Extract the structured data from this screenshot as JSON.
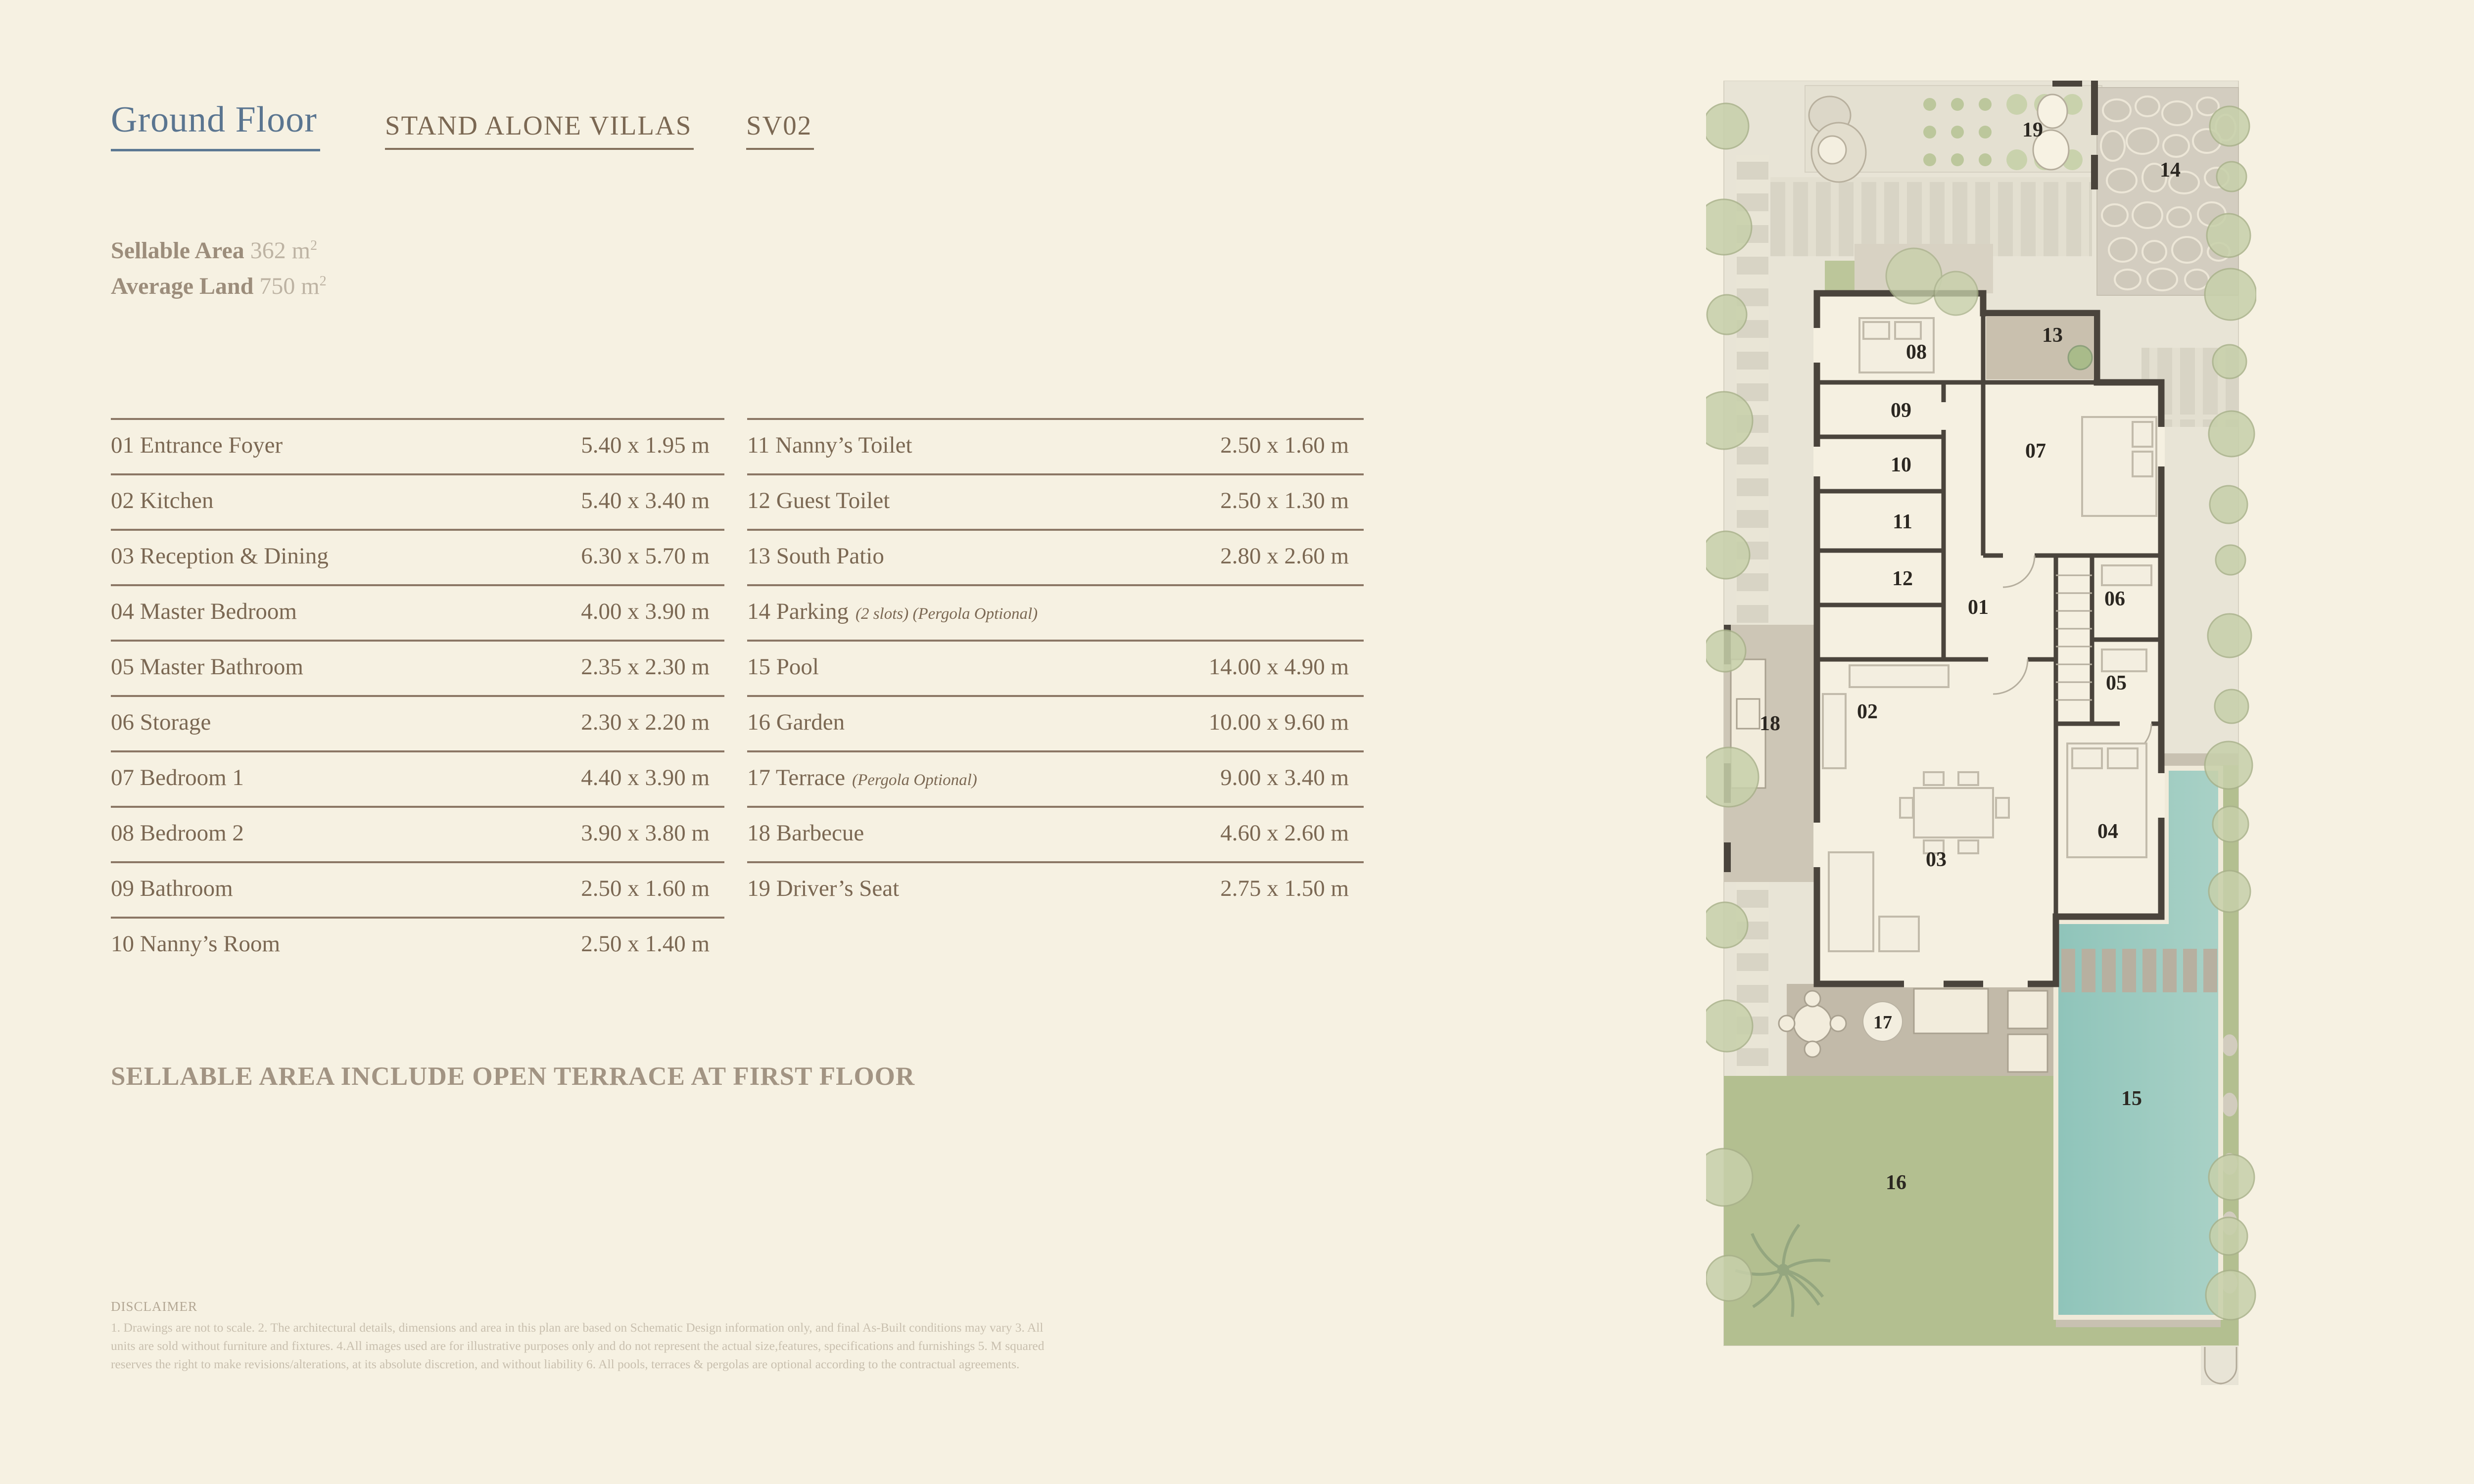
{
  "header": {
    "floor_label": "Ground Floor",
    "collection": "STAND ALONE VILLAS",
    "unit": "SV02"
  },
  "stats": {
    "sellable_label": "Sellable Area",
    "sellable_value": "362 m",
    "average_label": "Average Land",
    "average_value": "750 m",
    "area_exponent": "2"
  },
  "rooms_table": {
    "left": [
      {
        "label": "01 Entrance Foyer",
        "note": "",
        "dims": "5.40 x 1.95 m"
      },
      {
        "label": "02 Kitchen",
        "note": "",
        "dims": "5.40 x 3.40 m"
      },
      {
        "label": "03 Reception & Dining",
        "note": "",
        "dims": "6.30 x 5.70 m"
      },
      {
        "label": "04 Master Bedroom",
        "note": "",
        "dims": "4.00 x 3.90 m"
      },
      {
        "label": "05 Master Bathroom",
        "note": "",
        "dims": "2.35 x 2.30 m"
      },
      {
        "label": "06 Storage",
        "note": "",
        "dims": "2.30 x 2.20 m"
      },
      {
        "label": "07 Bedroom 1",
        "note": "",
        "dims": "4.40 x 3.90 m"
      },
      {
        "label": "08 Bedroom 2",
        "note": "",
        "dims": "3.90 x 3.80 m"
      },
      {
        "label": "09 Bathroom",
        "note": "",
        "dims": "2.50 x 1.60 m"
      },
      {
        "label": "10 Nanny’s Room",
        "note": "",
        "dims": "2.50 x 1.40 m"
      }
    ],
    "right": [
      {
        "label": "11 Nanny’s Toilet",
        "note": "",
        "dims": "2.50 x 1.60 m"
      },
      {
        "label": "12 Guest Toilet",
        "note": "",
        "dims": "2.50 x 1.30 m"
      },
      {
        "label": "13 South Patio",
        "note": "",
        "dims": "2.80 x 2.60 m"
      },
      {
        "label": "14 Parking",
        "note": "(2 slots) (Pergola Optional)",
        "dims": ""
      },
      {
        "label": "15 Pool",
        "note": "",
        "dims": "14.00 x 4.90 m"
      },
      {
        "label": "16 Garden",
        "note": "",
        "dims": "10.00 x 9.60 m"
      },
      {
        "label": "17 Terrace",
        "note": "(Pergola Optional)",
        "dims": "9.00 x 3.40 m"
      },
      {
        "label": "18 Barbecue",
        "note": "",
        "dims": "4.60 x 2.60 m"
      },
      {
        "label": "19 Driver’s Seat",
        "note": "",
        "dims": "2.75 x 1.50 m"
      }
    ]
  },
  "note": "SELLABLE AREA INCLUDE OPEN TERRACE AT FIRST FLOOR",
  "disclaimer": {
    "title": "DISCLAIMER",
    "body": "1. Drawings are not to scale. 2. The architectural details, dimensions and area in this plan are based on Schematic Design information only, and final As-Built conditions may vary 3. All units are sold without furniture and fixtures. 4.All images used are for illustrative purposes only and do not represent the actual size,features, specifications and furnishings 5. M squared reserves the right to make revisions/alterations, at its absolute discretion, and without liability 6. All pools, terraces & pergolas are optional according to the contractual agreements."
  },
  "floor_plan": {
    "labels": [
      {
        "id": "01"
      },
      {
        "id": "02"
      },
      {
        "id": "03"
      },
      {
        "id": "04"
      },
      {
        "id": "05"
      },
      {
        "id": "06"
      },
      {
        "id": "07"
      },
      {
        "id": "08"
      },
      {
        "id": "09"
      },
      {
        "id": "10"
      },
      {
        "id": "11"
      },
      {
        "id": "12"
      },
      {
        "id": "13"
      },
      {
        "id": "14"
      },
      {
        "id": "15"
      },
      {
        "id": "16"
      },
      {
        "id": "17"
      },
      {
        "id": "18"
      },
      {
        "id": "19"
      }
    ],
    "colors": {
      "accent_blue": "#5a7590",
      "accent_brown": "#7b6853",
      "wall": "#4a443c",
      "pool": "#96c5bb",
      "garden": "#b3bf90",
      "terrace": "#c2baa9",
      "plot": "#e8e4d6"
    }
  }
}
